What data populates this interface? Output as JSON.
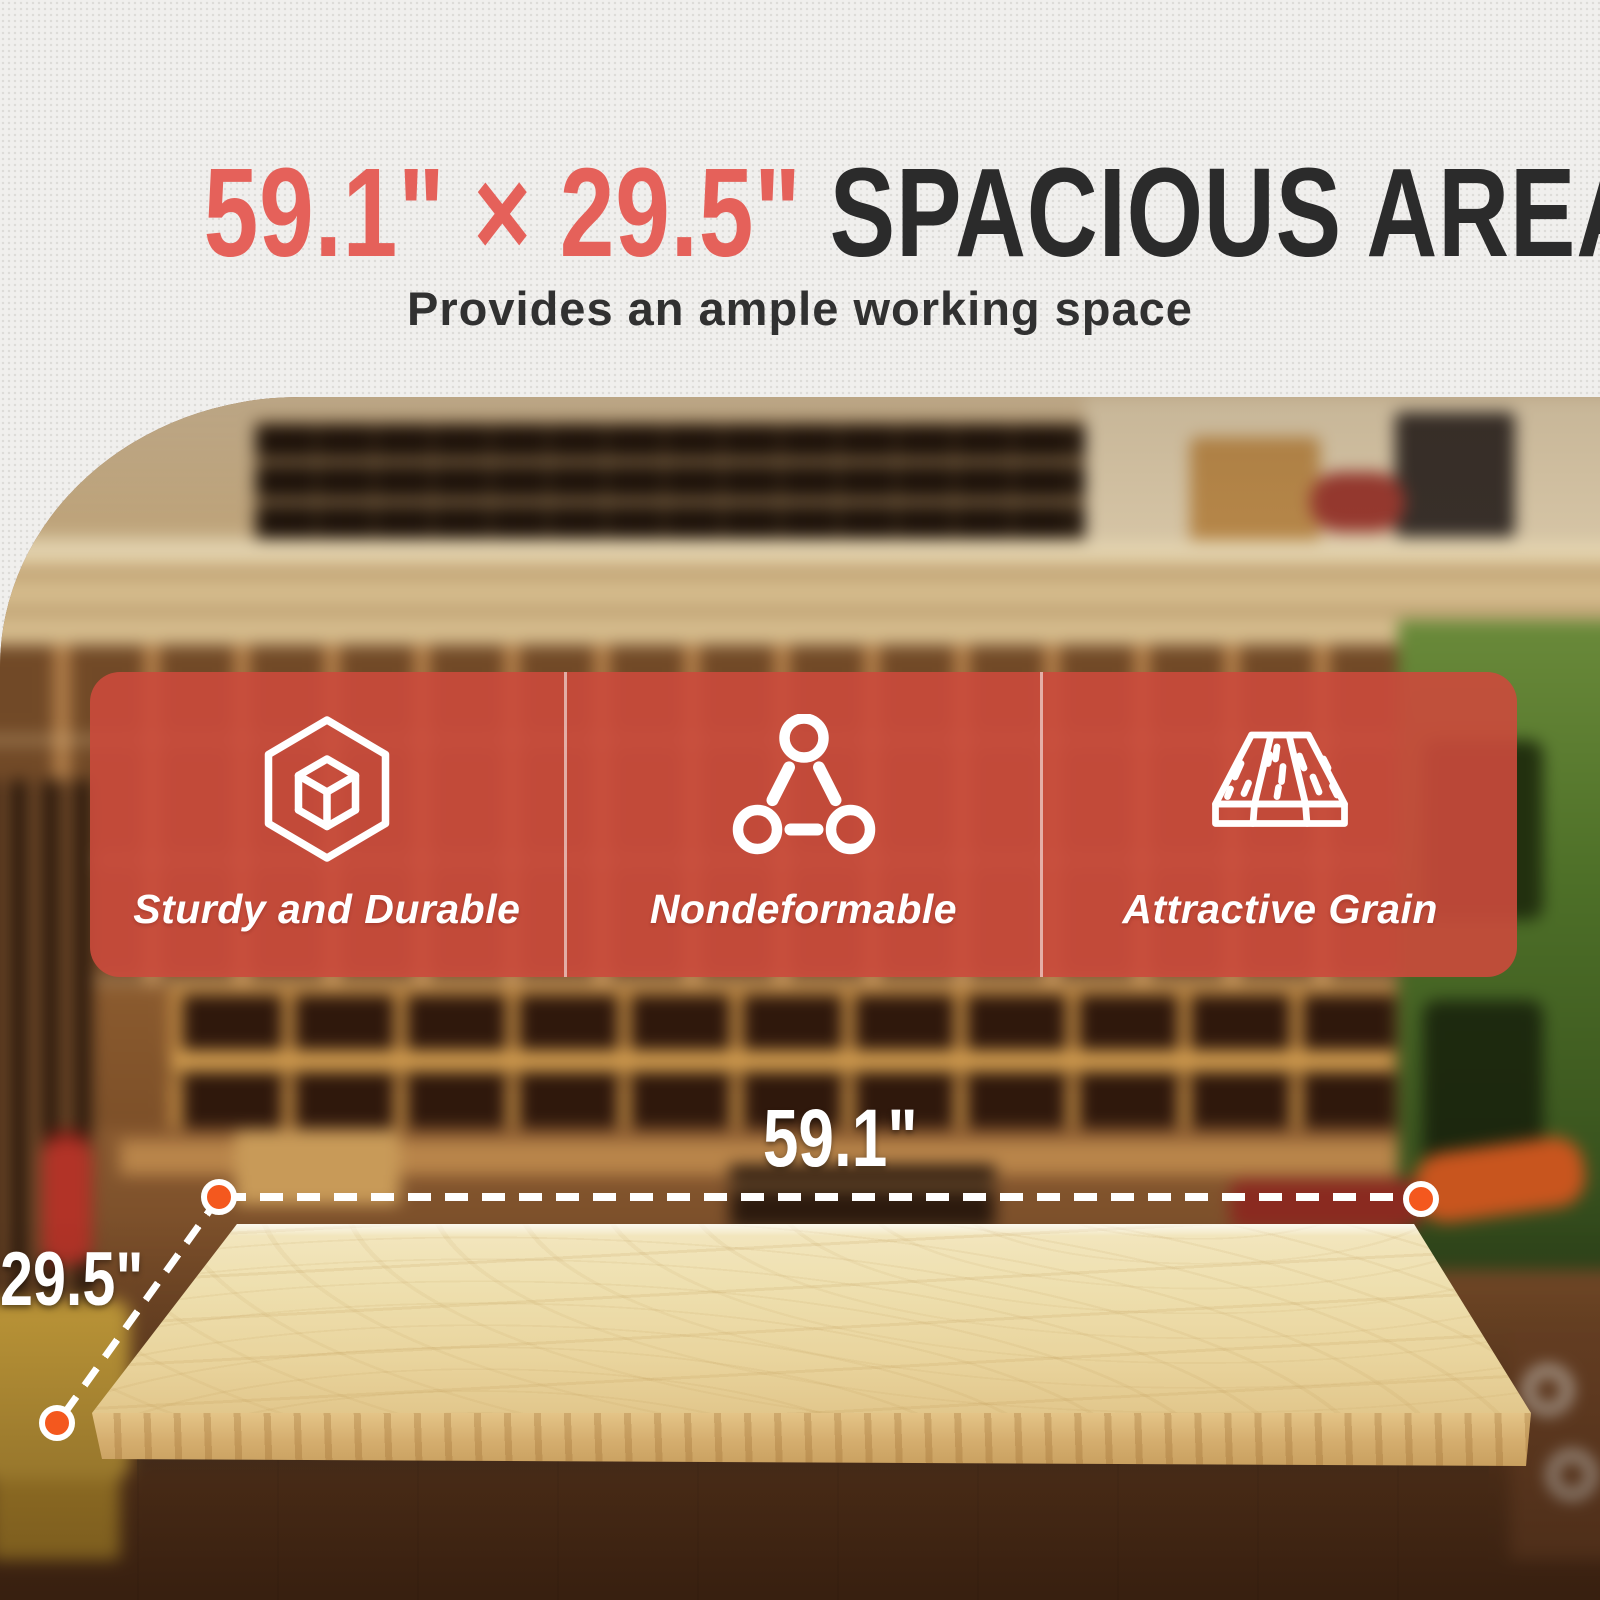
{
  "title": {
    "red_part": "59.1\" × 29.5\"",
    "dark_part": "SPACIOUS AREA",
    "subtitle": "Provides an ample working space"
  },
  "features": [
    {
      "icon": "cube-hexagon-icon",
      "label": "Sturdy and Durable"
    },
    {
      "icon": "triangle-nodes-icon",
      "label": "Nondeformable"
    },
    {
      "icon": "wood-plank-icon",
      "label": "Attractive Grain"
    }
  ],
  "dimensions": {
    "width": "59.1\"",
    "depth": "29.5\""
  },
  "colors": {
    "accent_red": "#e5615a",
    "banner_red": "#cb4a3c",
    "dot_orange": "#f4581e",
    "wood": "#eedfae",
    "wall": "#f0efed"
  },
  "scene": "Blurred woodworking workshop with parts bins, cubby shelves, green bandsaw and fire extinguisher behind a light-wood tabletop on a white base"
}
